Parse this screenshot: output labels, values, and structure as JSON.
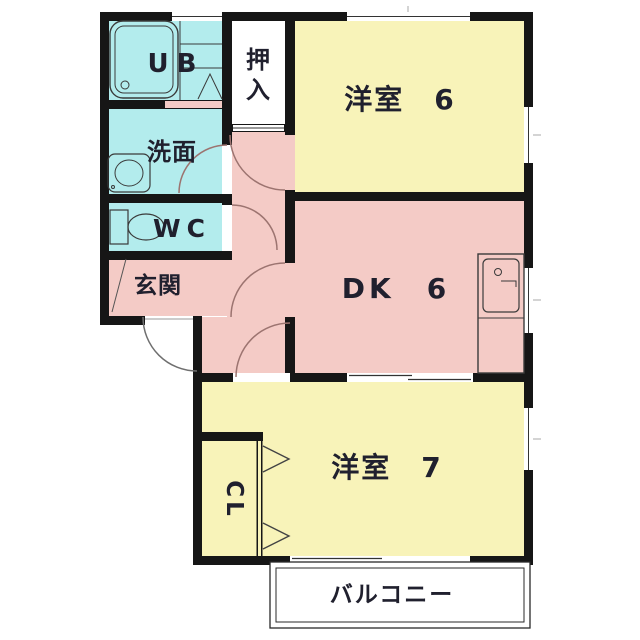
{
  "floorplan": {
    "type": "apartment-floor-plan",
    "rooms": {
      "ub": {
        "label": "UB"
      },
      "oshiire": {
        "label": "押入",
        "char_top": "押",
        "char_bottom": "入"
      },
      "senmen": {
        "label": "洗面"
      },
      "wc": {
        "label": "WC"
      },
      "genkan": {
        "label": "玄関"
      },
      "western6": {
        "label": "洋室　6"
      },
      "dk": {
        "label": "DK　6"
      },
      "western7": {
        "label": "洋室　7"
      },
      "cl": {
        "label": "CL"
      },
      "balcony": {
        "label": "バルコニー"
      }
    },
    "colors": {
      "wall": "#161616",
      "room_yellow": "#f8f3b9",
      "room_pink": "#f4cbc6",
      "room_cyan": "#b3eced",
      "door_arc": "#9c7470",
      "background": "#ffffff"
    }
  }
}
